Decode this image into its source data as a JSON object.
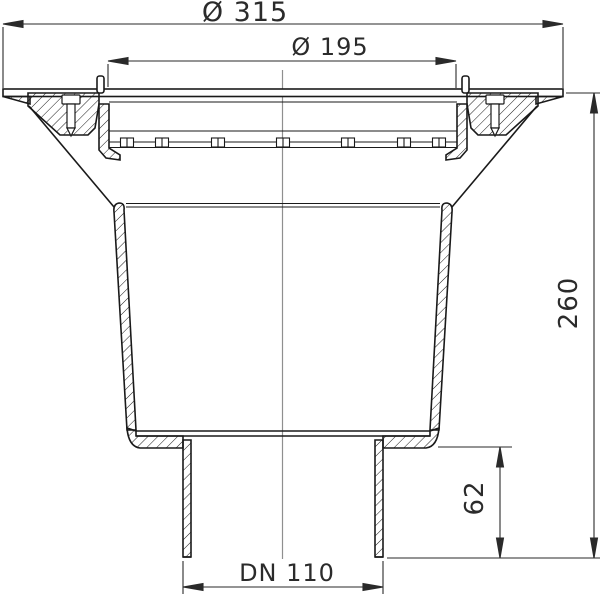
{
  "drawing": {
    "title": "drain-cross-section",
    "dimensions": {
      "top_outer_diameter": "Ø 315",
      "top_inner_diameter": "Ø 195",
      "total_height": "260",
      "outlet_stub_height": "62",
      "outlet_nominal": "DN 110"
    },
    "colors": {
      "body_line": "#1a1a1a",
      "dimension_line": "#2a2a2a",
      "centerline": "#8f8f8f",
      "background": "#ffffff"
    }
  }
}
